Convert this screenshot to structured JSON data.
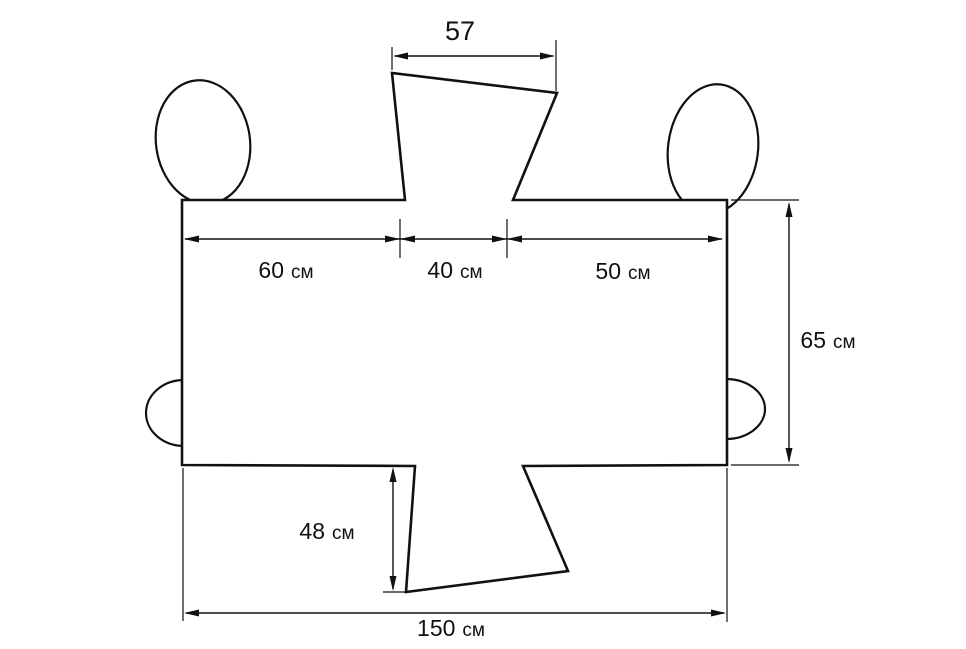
{
  "diagram": {
    "description": "Dimensioned cutting pattern of a cover with top and bottom flaps, two shoulder ellipses and two side bumps",
    "colors": {
      "line": "#111111",
      "background": "#ffffff"
    },
    "dimensions": {
      "top_flap_width": {
        "value": "57",
        "unit": ""
      },
      "top_left_segment": {
        "value": "60",
        "unit": "см"
      },
      "top_middle_segment": {
        "value": "40",
        "unit": "см"
      },
      "top_right_segment": {
        "value": "50",
        "unit": "см"
      },
      "right_height": {
        "value": "65",
        "unit": "см"
      },
      "bottom_flap_height": {
        "value": "48",
        "unit": "см"
      },
      "total_width": {
        "value": "150",
        "unit": "см"
      }
    }
  }
}
